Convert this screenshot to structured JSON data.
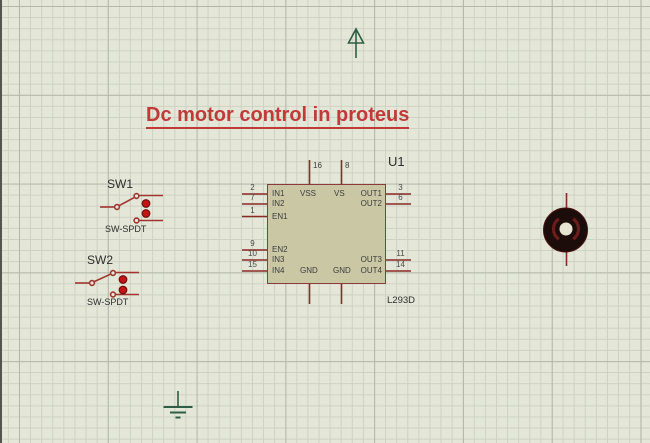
{
  "title": {
    "text": "Dc motor control in proteus"
  },
  "colors": {
    "canvas_bg": "#e4e7d8",
    "grid_minor": "#cdd1c3",
    "grid_major": "#b3b7a9",
    "pin_red": "#8a2a25",
    "switch_red": "#a03530",
    "toggle_dot_red": "#c41414",
    "chip_fill": "#c9c7a4",
    "chip_border": "#8c3a3a",
    "title_red": "#c13a3a",
    "terminal_green": "#2e5e45",
    "motor_body": "#1c0c0a",
    "motor_arc": "#6b1d1d",
    "label_text": "#2e2e2e"
  },
  "components": {
    "ic": {
      "ref": "U1",
      "value": "L293D",
      "left_pins": [
        {
          "num": "2",
          "name": "IN1"
        },
        {
          "num": "7",
          "name": "IN2"
        },
        {
          "num": "1",
          "name": "EN1"
        },
        {
          "num": "9",
          "name": "EN2"
        },
        {
          "num": "10",
          "name": "IN3"
        },
        {
          "num": "15",
          "name": "IN4"
        }
      ],
      "right_pins": [
        {
          "num": "3",
          "name": "OUT1"
        },
        {
          "num": "6",
          "name": "OUT2"
        },
        {
          "num": "11",
          "name": "OUT3"
        },
        {
          "num": "14",
          "name": "OUT4"
        }
      ],
      "top_pins": [
        {
          "num": "16",
          "name": "VSS"
        },
        {
          "num": "8",
          "name": "VS"
        }
      ],
      "bottom_labels": [
        "GND",
        "GND"
      ]
    },
    "switch1": {
      "ref": "SW1",
      "type": "SW-SPDT"
    },
    "switch2": {
      "ref": "SW2",
      "type": "SW-SPDT"
    },
    "motor": {
      "name": "dc-motor"
    },
    "power": {
      "name": "power-terminal"
    },
    "ground": {
      "name": "ground-terminal"
    }
  }
}
